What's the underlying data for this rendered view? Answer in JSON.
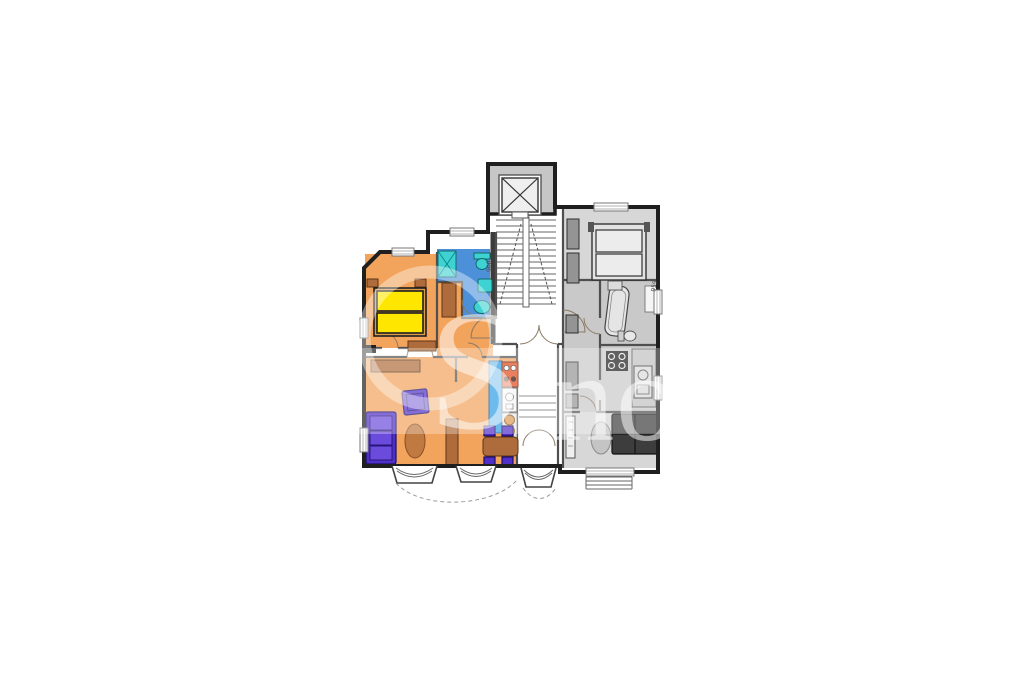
{
  "colors": {
    "page_bg": "#ffffff",
    "outer_wall": "#1f1f1f",
    "inner_wall": "#4f4f4f",
    "wall_fill": "#c6c6c6",
    "orange": "#f2a35c",
    "bath_blue": "#4b90d9",
    "fixture_cyan": "#3ed2d2",
    "bed_yellow": "#ffe600",
    "furn_brown": "#ae6c3c",
    "rug_brown": "#c07a41",
    "furn_purple": "#4f2fc7",
    "counter_blue": "#2e9ce4",
    "stove_red": "#e0481a",
    "appliance_tan": "#dd9a55",
    "gray_room_a": "#d7d7d7",
    "gray_room_b": "#c9c9c9",
    "gray_furn": "#949494",
    "sofa_dark": "#3d3d3d",
    "floor_white": "#ffffff",
    "watermark": "rgba(255,255,255,0.52)"
  },
  "labels": {
    "dim_left": "900",
    "dim_right": "959"
  },
  "watermark": {
    "letters": [
      "S",
      "n",
      "o"
    ]
  }
}
